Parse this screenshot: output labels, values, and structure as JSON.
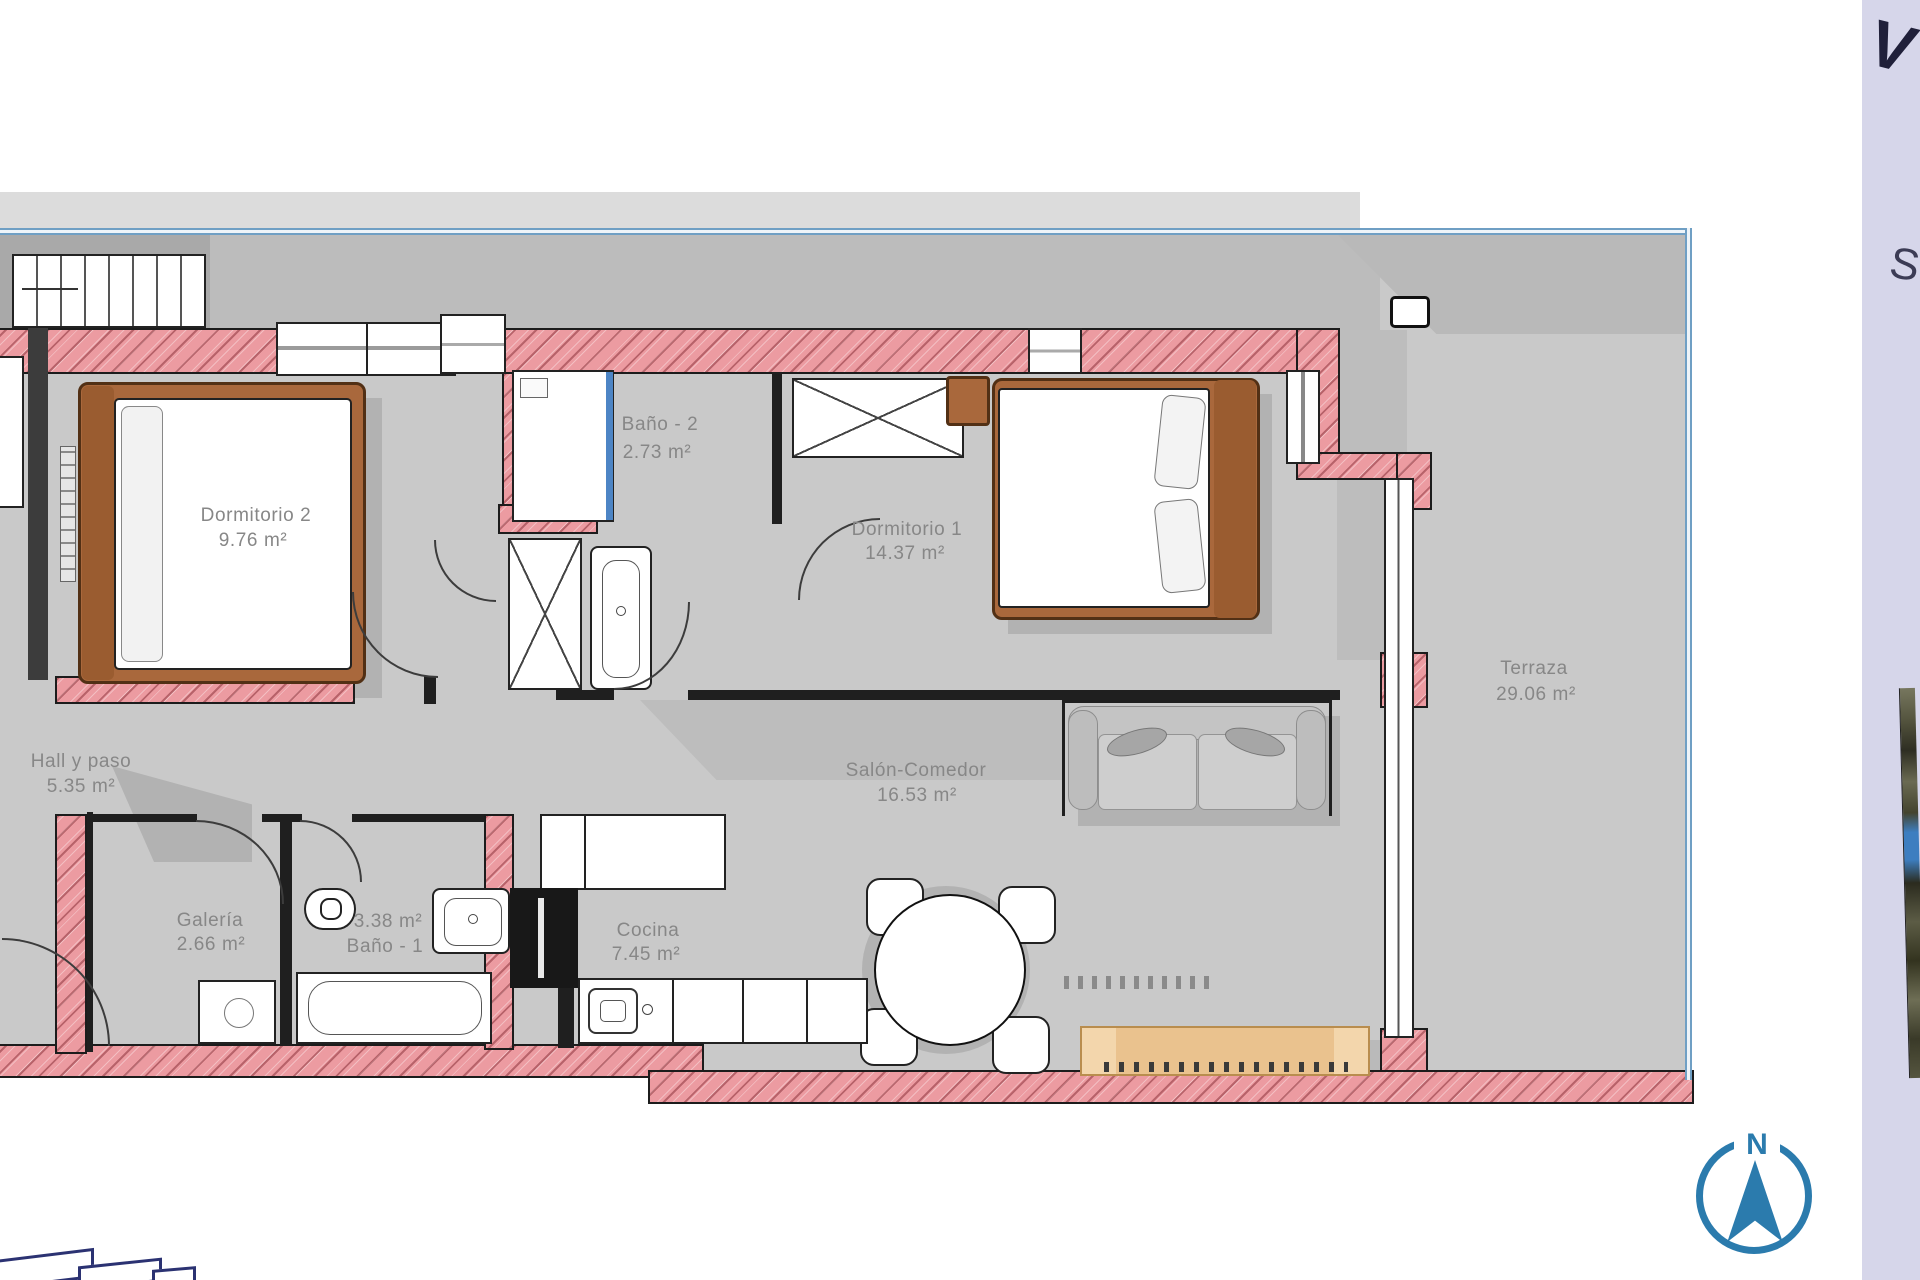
{
  "document": {
    "kind": "apartment floor plan",
    "language": "es"
  },
  "rooms": [
    {
      "name": "Dormitorio 2",
      "area": "9.76 m²"
    },
    {
      "name": "Baño - 2",
      "area": "2.73 m²"
    },
    {
      "name": "Dormitorio 1",
      "area": "14.37 m²"
    },
    {
      "name": "Terraza",
      "area": "29.06 m²"
    },
    {
      "name": "Hall y paso",
      "area": "5.35 m²"
    },
    {
      "name": "Galería",
      "area": "2.66 m²"
    },
    {
      "name": "Baño - 1",
      "area": "3.38 m²"
    },
    {
      "name": "Cocina",
      "area": "7.45 m²"
    },
    {
      "name": "Salón-Comedor",
      "area": "16.53 m²"
    }
  ],
  "compass": {
    "label": "N"
  },
  "side_panel": {
    "letter_top": "V",
    "letter_mid": "S"
  },
  "colors": {
    "wall_pink": "#ec9ba1",
    "floor_gray": "#c9c9c9",
    "frame_blue": "#6f9fc4",
    "glass_blue": "#4d85c5",
    "compass_blue": "#2b7bad",
    "wood_brown": "#a9683c",
    "bench_tan": "#eac28e",
    "panel_lavender": "#d6d6ea"
  }
}
